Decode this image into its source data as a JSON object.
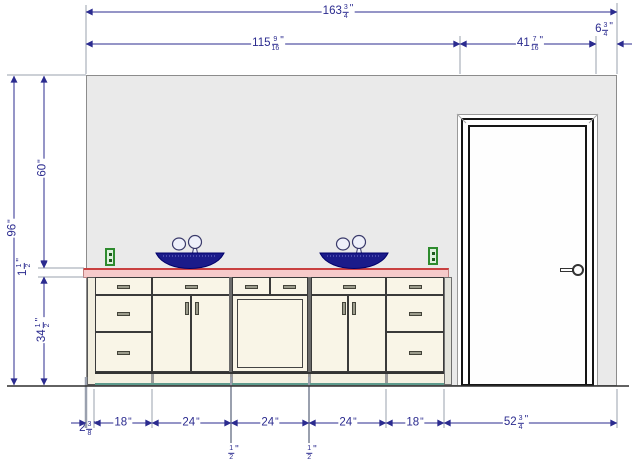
{
  "drawing": {
    "kind": "bathroom vanity wall elevation",
    "colors": {
      "wall": "#eaeaea",
      "counter_fill": "#f6caca",
      "counter_edge": "#c94040",
      "cabinet": "#f9f5e7",
      "sink": "#1b1b8a",
      "outlet_green": "#2e8b2e",
      "dimension_navy": "#2b2b8f",
      "toe_kick_accent": "#5e9b8d"
    },
    "icons": {
      "sink": "vessel-sink-icon",
      "faucet": "faucet-icon",
      "outlet": "power-outlet-icon",
      "door_knob": "door-knob-icon"
    }
  },
  "dims": {
    "total_width": {
      "whole": "163",
      "num": "3",
      "den": "4",
      "unit": "\""
    },
    "wall_to_door": {
      "whole": "115",
      "num": "9",
      "den": "16",
      "unit": "\""
    },
    "door_width": {
      "whole": "41",
      "num": "7",
      "den": "16",
      "unit": "\""
    },
    "door_to_corner": {
      "whole": "6",
      "num": "3",
      "den": "4",
      "unit": "\""
    },
    "wall_height": {
      "whole": "96",
      "unit": "\""
    },
    "above_counter": {
      "whole": "60",
      "unit": "\""
    },
    "counter_thickness": {
      "whole": "1",
      "num": "1",
      "den": "2",
      "unit": "\""
    },
    "counter_height": {
      "whole": "34",
      "num": "1",
      "den": "2",
      "unit": "\""
    },
    "left_filler": {
      "whole": "2",
      "num": "3",
      "den": "8",
      "unit": "\""
    },
    "cabinet_1": {
      "whole": "18",
      "unit": "\""
    },
    "cabinet_2": {
      "whole": "24",
      "unit": "\""
    },
    "cabinet_3": {
      "whole": "24",
      "unit": "\""
    },
    "cabinet_4": {
      "whole": "24",
      "unit": "\""
    },
    "cabinet_5": {
      "whole": "18",
      "unit": "\""
    },
    "door_section": {
      "whole": "52",
      "num": "3",
      "den": "4",
      "unit": "\""
    },
    "gap_1": {
      "num": "1",
      "den": "2",
      "unit": "\""
    },
    "gap_2": {
      "num": "1",
      "den": "2",
      "unit": "\""
    }
  }
}
